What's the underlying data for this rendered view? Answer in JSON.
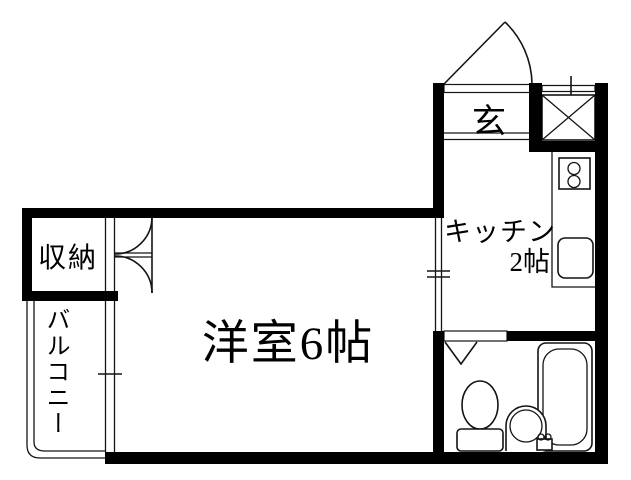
{
  "colors": {
    "wall": "#000000",
    "line": "#141414",
    "floor": "#ffffff",
    "background": "#ffffff"
  },
  "rooms": {
    "entrance": {
      "label": "玄"
    },
    "kitchen": {
      "label": "キッチン",
      "size": "2帖"
    },
    "western_room": {
      "label": "洋室6帖"
    },
    "storage": {
      "label": "収納"
    },
    "balcony": {
      "label": "バルコニー"
    }
  },
  "fixtures": {
    "entry_door": "swing-door",
    "shaft_box": "x-crossed-box",
    "stove": "two-burner-stove",
    "kitchen_sink": "kitchen-sink",
    "closet_doors": "double-swing-doors",
    "balcony_window": "sliding-window",
    "room_kitchen_opening": "window-opening",
    "bath_door": "folding-door",
    "toilet": "toilet",
    "washbasin": "round-washbasin",
    "bathtub": "bathtub"
  }
}
